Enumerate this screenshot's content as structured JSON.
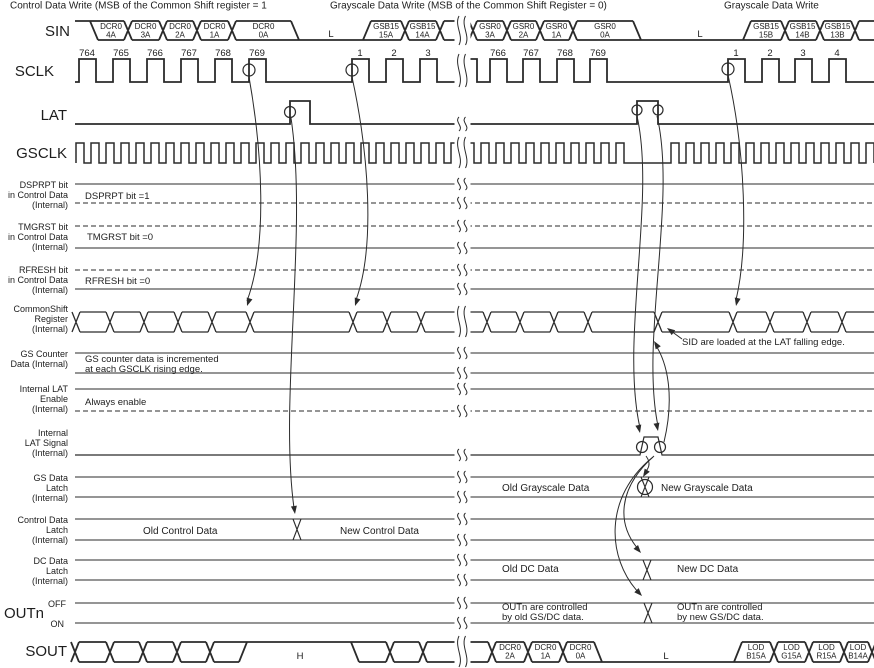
{
  "headers": [
    {
      "text": "Control Data Write (MSB of the Common Shift register = 1",
      "x": 10
    },
    {
      "text": "Grayscale Data Write (MSB of the Common Shift Register = 0)",
      "x": 330
    },
    {
      "text": "Grayscale Data Write",
      "x": 724
    }
  ],
  "signals": {
    "sin": {
      "label": "SIN",
      "tokens": [
        {
          "k": "level",
          "lev": "high",
          "x2": 94
        },
        {
          "k": "cell",
          "x2": 128,
          "t": "DCR0",
          "b": "4A"
        },
        {
          "k": "cell",
          "x2": 163,
          "t": "DCR0",
          "b": "3A"
        },
        {
          "k": "cell",
          "x2": 197,
          "t": "DCR0",
          "b": "2A"
        },
        {
          "k": "cell",
          "x2": 232,
          "t": "DCR0",
          "b": "1A"
        },
        {
          "k": "cell",
          "x2": 295,
          "t": "DCR0",
          "b": "0A"
        },
        {
          "k": "level",
          "lev": "low",
          "x2": 367,
          "text": "L",
          "tx": 331
        },
        {
          "k": "cell",
          "x2": 405,
          "t": "GSB15",
          "b": "15A"
        },
        {
          "k": "cell",
          "x2": 440,
          "t": "GSB15",
          "b": "14A"
        },
        {
          "k": "cell",
          "x2": 473
        },
        {
          "k": "cell",
          "x2": 507,
          "t": "GSR0",
          "b": "3A"
        },
        {
          "k": "cell",
          "x2": 540,
          "t": "GSR0",
          "b": "2A"
        },
        {
          "k": "cell",
          "x2": 573,
          "t": "GSR0",
          "b": "1A"
        },
        {
          "k": "cell",
          "x2": 637,
          "t": "GSR0",
          "b": "0A"
        },
        {
          "k": "level",
          "lev": "low",
          "x2": 747,
          "text": "L",
          "tx": 700
        },
        {
          "k": "cell",
          "x2": 785,
          "t": "GSB15",
          "b": "15B"
        },
        {
          "k": "cell",
          "x2": 820,
          "t": "GSB15",
          "b": "14B"
        },
        {
          "k": "cell",
          "x2": 855,
          "t": "GSB15",
          "b": "13B"
        },
        {
          "k": "cell",
          "x2": 874,
          "open": true
        }
      ]
    },
    "sclk": {
      "label": "SCLK",
      "pulses": [
        {
          "x": 79,
          "n": "764"
        },
        {
          "x": 113,
          "n": "765"
        },
        {
          "x": 147,
          "n": "766"
        },
        {
          "x": 181,
          "n": "767"
        },
        {
          "x": 215,
          "n": "768"
        },
        {
          "x": 249,
          "n": "769"
        },
        {
          "x": 352,
          "n": "1"
        },
        {
          "x": 386,
          "n": "2"
        },
        {
          "x": 420,
          "n": "3"
        },
        {
          "x": 460,
          "n": ""
        },
        {
          "x": 490,
          "n": "766"
        },
        {
          "x": 523,
          "n": "767"
        },
        {
          "x": 557,
          "n": "768"
        },
        {
          "x": 590,
          "n": "769"
        },
        {
          "x": 728,
          "n": "1"
        },
        {
          "x": 762,
          "n": "2"
        },
        {
          "x": 795,
          "n": "3"
        },
        {
          "x": 829,
          "n": "4"
        }
      ]
    },
    "lat": {
      "label": "LAT"
    },
    "gsclk": {
      "label": "GSCLK"
    },
    "dsprpt": {
      "rows": [
        "DSPRPT bit",
        "in Control Data",
        "(Internal)"
      ],
      "note": "DSPRPT bit =1"
    },
    "tmgrst": {
      "rows": [
        "TMGRST bit",
        "in Control Data",
        "(Internal)"
      ],
      "note": "TMGRST bit =0"
    },
    "rfresh": {
      "rows": [
        "RFRESH bit",
        "in Control Data",
        "(Internal)"
      ],
      "note": "RFRESH bit =0"
    },
    "shift": {
      "rows": [
        "CommonShift",
        "Register",
        "(Internal)"
      ],
      "tokens": [
        {
          "k": "cell",
          "x2": 110
        },
        {
          "k": "cell",
          "x2": 144
        },
        {
          "k": "cell",
          "x2": 178
        },
        {
          "k": "cell",
          "x2": 212
        },
        {
          "k": "cell",
          "x2": 250
        },
        {
          "k": "cell",
          "x2": 353
        },
        {
          "k": "cell",
          "x2": 387
        },
        {
          "k": "cell",
          "x2": 421
        },
        {
          "k": "cell",
          "x2": 487
        },
        {
          "k": "cell",
          "x2": 520
        },
        {
          "k": "cell",
          "x2": 554
        },
        {
          "k": "cell",
          "x2": 588
        },
        {
          "k": "cell",
          "x2": 658
        },
        {
          "k": "cell",
          "x2": 733
        },
        {
          "k": "cell",
          "x2": 770
        },
        {
          "k": "cell",
          "x2": 807
        },
        {
          "k": "cell",
          "x2": 842
        },
        {
          "k": "cell",
          "x2": 874,
          "open": true
        }
      ]
    },
    "gscnt": {
      "rows": [
        "GS Counter",
        "Data (Internal)"
      ],
      "note1": "GS counter data is incremented",
      "note2": "at each GSCLK rising edge."
    },
    "laten": {
      "rows": [
        "Internal LAT",
        "Enable",
        "(Internal)"
      ],
      "note": "Always enable"
    },
    "ilat": {
      "rows": [
        "Internal",
        "LAT Signal",
        "(Internal)"
      ]
    },
    "gsdata": {
      "rows": [
        "GS Data",
        "Latch",
        "(Internal)"
      ],
      "old": "Old Grayscale Data",
      "new": "New Grayscale Data"
    },
    "ctrl": {
      "rows": [
        "Control Data",
        "Latch",
        "(Internal)"
      ],
      "old": "Old Control Data",
      "new": "New Control Data"
    },
    "dcdata": {
      "rows": [
        "DC Data",
        "Latch",
        "(Internal)"
      ],
      "old": "Old DC Data",
      "new": "New DC Data"
    },
    "outn": {
      "label": "OUTn",
      "off": "OFF",
      "on": "ON",
      "old1": "OUTn are controlled",
      "old2": "by old GS/DC data.",
      "new1": "OUTn are controlled",
      "new2": "by new GS/DC data."
    },
    "sout": {
      "label": "SOUT",
      "tokens": [
        {
          "k": "cell",
          "x2": 110
        },
        {
          "k": "cell",
          "x2": 143
        },
        {
          "k": "cell",
          "x2": 177
        },
        {
          "k": "cell",
          "x2": 210
        },
        {
          "k": "cell",
          "x2": 243
        },
        {
          "k": "level",
          "lev": "high",
          "x2": 355,
          "text": "H",
          "tx": 300
        },
        {
          "k": "cell",
          "x2": 390
        },
        {
          "k": "cell",
          "x2": 423
        },
        {
          "k": "cell",
          "x2": 492
        },
        {
          "k": "cell",
          "x2": 528,
          "t": "DCR0",
          "b": "2A"
        },
        {
          "k": "cell",
          "x2": 563,
          "t": "DCR0",
          "b": "1A"
        },
        {
          "k": "cell",
          "x2": 598,
          "t": "DCR0",
          "b": "0A"
        },
        {
          "k": "level",
          "lev": "low",
          "x2": 738,
          "text": "L",
          "tx": 666
        },
        {
          "k": "cell",
          "x2": 774,
          "t": "LOD",
          "b": "B15A"
        },
        {
          "k": "cell",
          "x2": 809,
          "t": "LOD",
          "b": "G15A"
        },
        {
          "k": "cell",
          "x2": 844,
          "t": "LOD",
          "b": "R15A"
        },
        {
          "k": "cell",
          "x2": 872,
          "t": "LOD",
          "b": "B14A"
        },
        {
          "k": "cell",
          "x2": 874,
          "open": true
        }
      ]
    }
  },
  "annotation": {
    "sid": "SID are loaded at the LAT falling edge."
  }
}
